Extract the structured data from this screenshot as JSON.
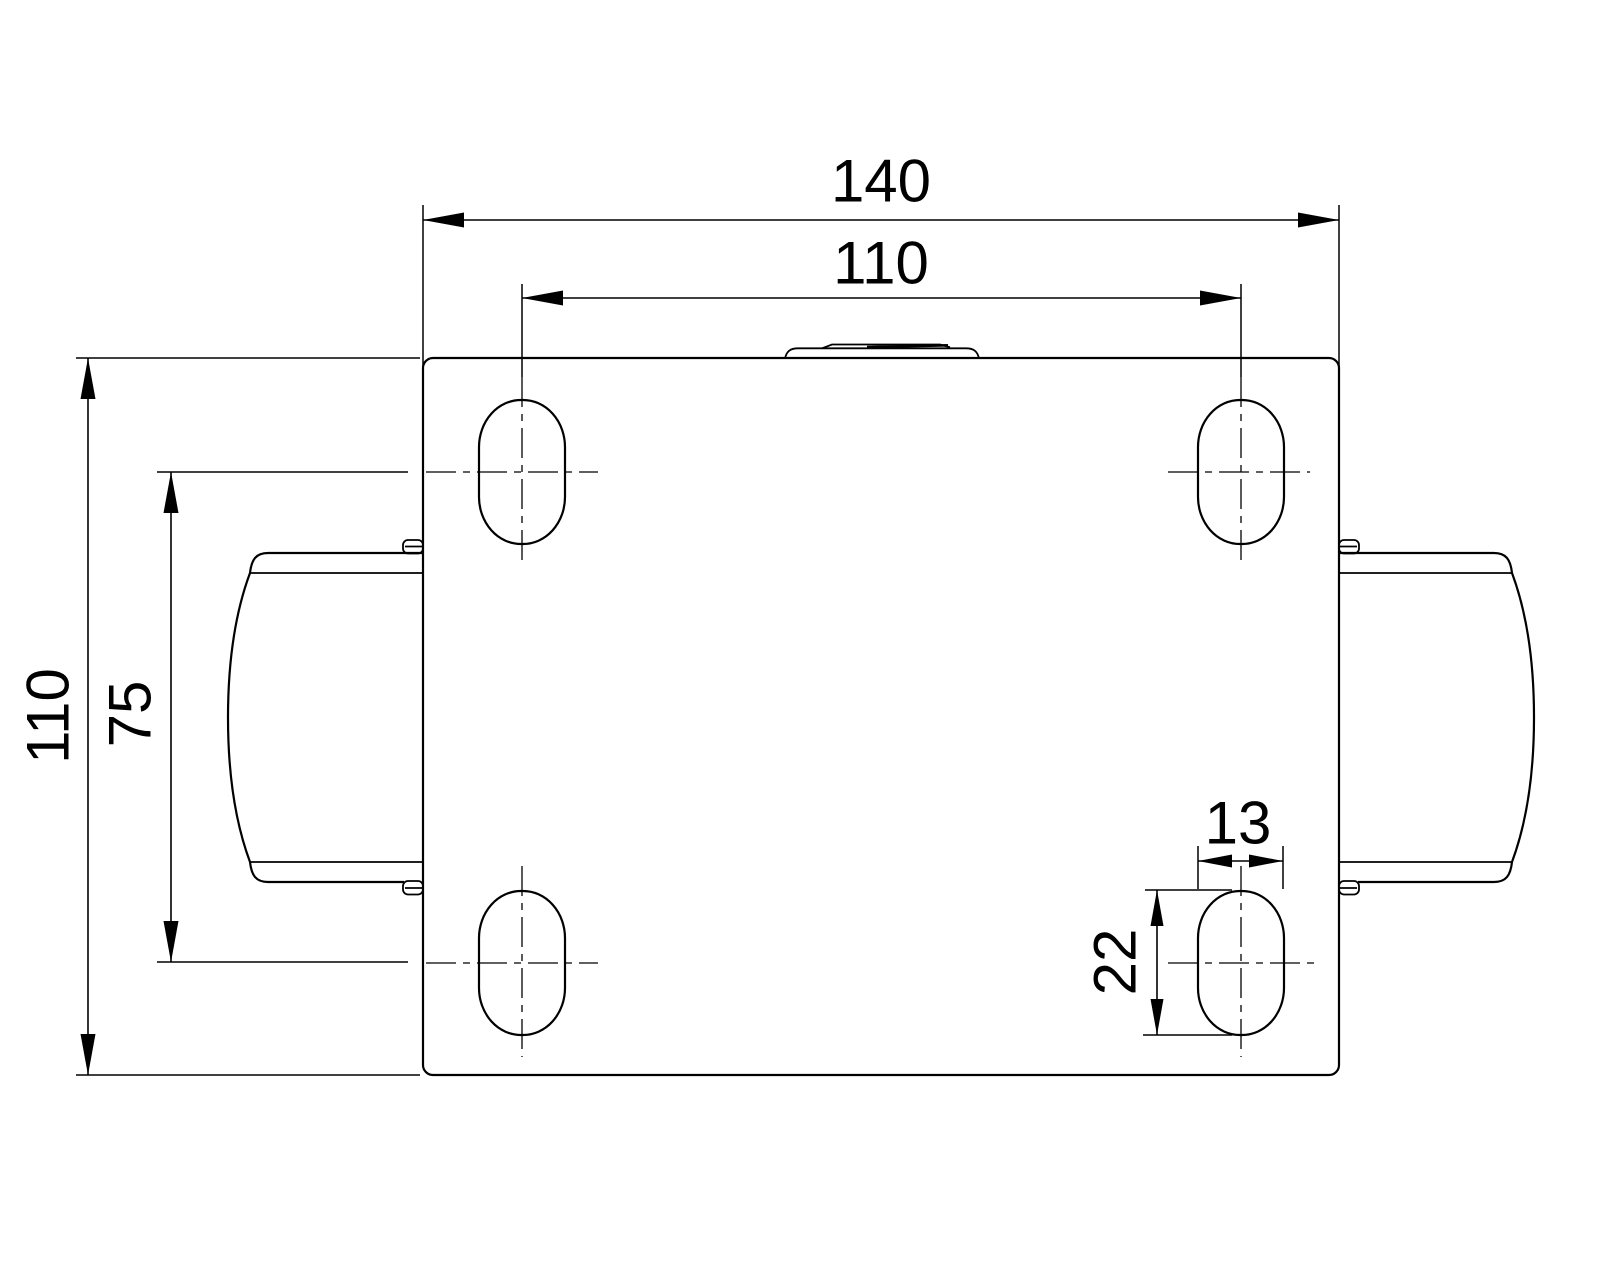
{
  "drawing": {
    "background_color": "#ffffff",
    "line_color": "#000000",
    "dimensions": {
      "plate_width": "140",
      "bolt_pattern_width": "110",
      "plate_depth": "110",
      "bolt_pattern_depth": "75",
      "slot_width": "13",
      "slot_length": "22"
    }
  }
}
